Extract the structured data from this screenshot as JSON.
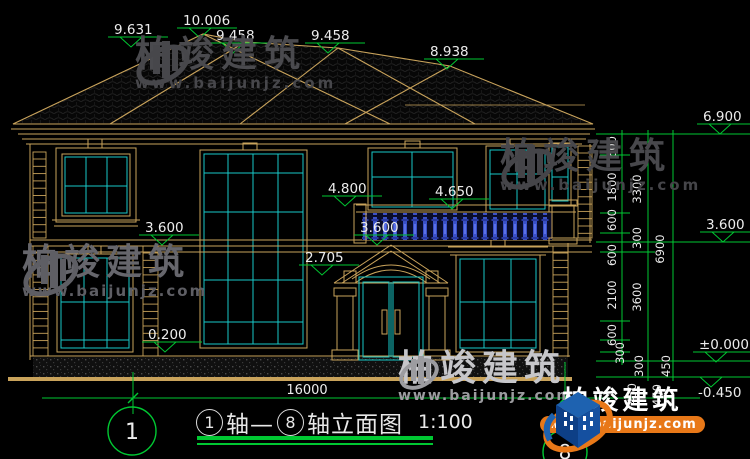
{
  "colors": {
    "background": "#000000",
    "line_tan": "#c9a35b",
    "window_cyan": "#18c8c8",
    "dim_green": "#00c832",
    "balustrade_blue": "#3a50c8",
    "text_white": "#ececec",
    "logo_orange": "#e87818",
    "logo_blue": "#1e62b0"
  },
  "title": {
    "bubble1": "1",
    "segment1": "轴—",
    "bubble2": "8",
    "segment2": "轴立面图",
    "scale": "1:100"
  },
  "axis_bubbles": {
    "left": "1",
    "right": "8"
  },
  "watermark": {
    "brand": "柏竣建筑",
    "url": "www.baijunjz.com"
  },
  "logo": {
    "brand": "柏竣建筑",
    "url": "www.baijunjz.com"
  },
  "elevation_markers": [
    {
      "value": "9.631",
      "x": 114,
      "y": 34
    },
    {
      "value": "10.006",
      "x": 183,
      "y": 25
    },
    {
      "value": "9.458",
      "x": 216,
      "y": 40
    },
    {
      "value": "9.458",
      "x": 311,
      "y": 40
    },
    {
      "value": "8.938",
      "x": 430,
      "y": 56
    },
    {
      "value": "4.800",
      "x": 328,
      "y": 193
    },
    {
      "value": "4.650",
      "x": 435,
      "y": 196
    },
    {
      "value": "3.600",
      "x": 360,
      "y": 232
    },
    {
      "value": "2.705",
      "x": 305,
      "y": 262
    },
    {
      "value": "3.600",
      "x": 145,
      "y": 232
    },
    {
      "value": "0.200",
      "x": 148,
      "y": 339
    },
    {
      "value": "6.900",
      "x": 703,
      "y": 121,
      "line": [
        596,
        750,
        134
      ]
    },
    {
      "value": "3.600",
      "x": 706,
      "y": 229,
      "line": [
        596,
        750,
        242
      ]
    },
    {
      "value": "±0.000",
      "x": 699,
      "y": 349,
      "line": [
        596,
        750,
        361
      ]
    },
    {
      "value": "-0.450",
      "x": 698,
      "y": 397,
      "flip": true,
      "line": [
        596,
        750,
        377
      ]
    }
  ],
  "right_dim_labels": [
    {
      "x": 616,
      "y": 147,
      "t": "600"
    },
    {
      "x": 616,
      "y": 187,
      "t": "1800"
    },
    {
      "x": 616,
      "y": 220,
      "t": "600"
    },
    {
      "x": 616,
      "y": 255,
      "t": "600"
    },
    {
      "x": 616,
      "y": 295,
      "t": "2100"
    },
    {
      "x": 616,
      "y": 335,
      "t": "600"
    },
    {
      "x": 624,
      "y": 353,
      "t": "300"
    },
    {
      "x": 641,
      "y": 189,
      "t": "3300"
    },
    {
      "x": 641,
      "y": 238,
      "t": "300"
    },
    {
      "x": 641,
      "y": 297,
      "t": "3600"
    },
    {
      "x": 643,
      "y": 366,
      "t": "300"
    },
    {
      "x": 636,
      "y": 394,
      "t": "450"
    },
    {
      "x": 664,
      "y": 249,
      "t": "6900"
    },
    {
      "x": 670,
      "y": 366,
      "t": "450"
    },
    {
      "x": 661,
      "y": 395,
      "t": "450"
    }
  ],
  "bottom_dim": {
    "value": "16000",
    "x": 307,
    "y": 394
  }
}
